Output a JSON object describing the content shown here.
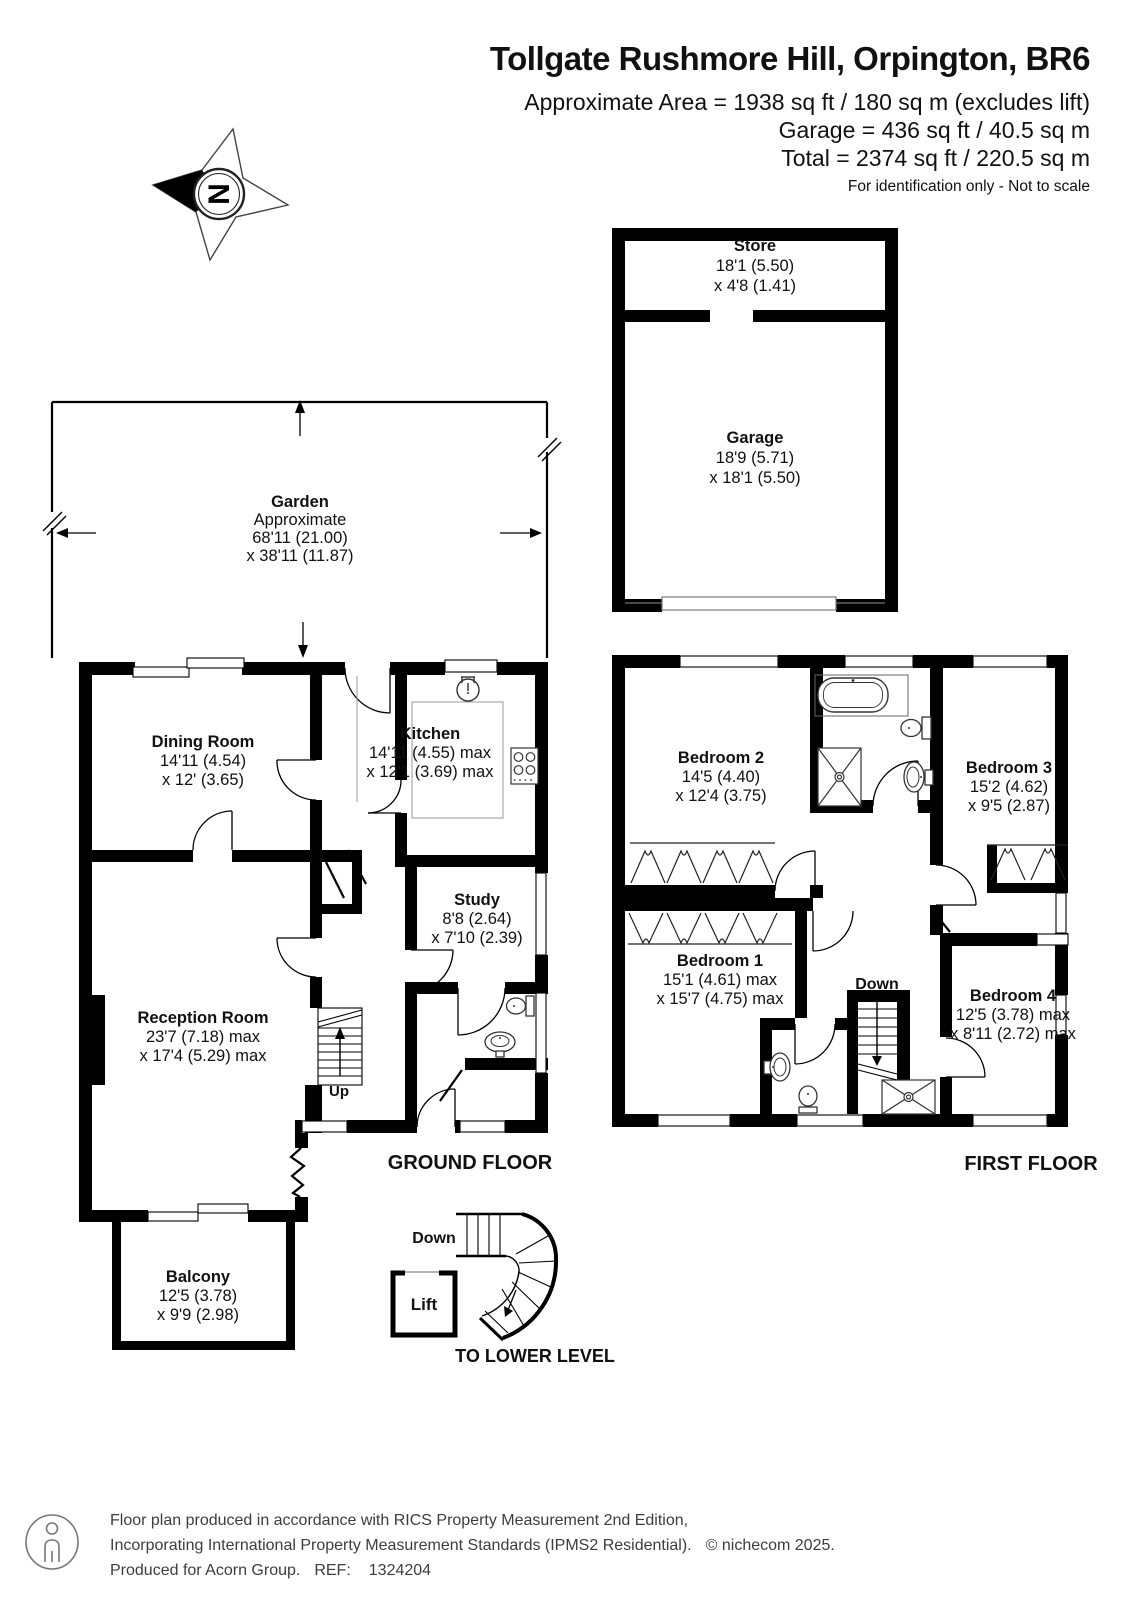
{
  "header": {
    "title": "Tollgate Rushmore Hill, Orpington, BR6",
    "area_line1": "Approximate Area = 1938 sq ft / 180 sq m (excludes lift)",
    "area_line2": "Garage = 436 sq ft / 40.5 sq m",
    "area_line3": "Total = 2374 sq ft / 220.5 sq m",
    "disclaimer": "For identification only - Not to scale"
  },
  "compass": {
    "north_label": "N"
  },
  "rooms": {
    "store": {
      "name": "Store",
      "dim1": "18'1 (5.50)",
      "dim2": "x 4'8 (1.41)"
    },
    "garage": {
      "name": "Garage",
      "dim1": "18'9 (5.71)",
      "dim2": "x 18'1 (5.50)"
    },
    "garden": {
      "name": "Garden",
      "note": "Approximate",
      "dim1": "68'11 (21.00)",
      "dim2": "x 38'11 (11.87)"
    },
    "dining_room": {
      "name": "Dining Room",
      "dim1": "14'11 (4.54)",
      "dim2": "x 12' (3.65)"
    },
    "kitchen": {
      "name": "Kitchen",
      "dim1": "14'11 (4.55) max",
      "dim2": "x 12'1 (3.69) max"
    },
    "study": {
      "name": "Study",
      "dim1": "8'8 (2.64)",
      "dim2": "x 7'10 (2.39)"
    },
    "reception_room": {
      "name": "Reception Room",
      "dim1": "23'7 (7.18) max",
      "dim2": "x 17'4 (5.29) max"
    },
    "balcony": {
      "name": "Balcony",
      "dim1": "12'5 (3.78)",
      "dim2": "x 9'9 (2.98)"
    },
    "bedroom_1": {
      "name": "Bedroom 1",
      "dim1": "15'1 (4.61) max",
      "dim2": "x 15'7 (4.75) max"
    },
    "bedroom_2": {
      "name": "Bedroom 2",
      "dim1": "14'5 (4.40)",
      "dim2": "x 12'4 (3.75)"
    },
    "bedroom_3": {
      "name": "Bedroom 3",
      "dim1": "15'2 (4.62)",
      "dim2": "x 9'5 (2.87)"
    },
    "bedroom_4": {
      "name": "Bedroom 4",
      "dim1": "12'5 (3.78) max",
      "dim2": "x 8'11 (2.72) max"
    },
    "lift": {
      "name": "Lift"
    }
  },
  "labels": {
    "ground_floor": "GROUND FLOOR",
    "first_floor": "FIRST FLOOR",
    "to_lower_level": "TO LOWER LEVEL",
    "up": "Up",
    "down": "Down"
  },
  "footer": {
    "line1": "Floor plan produced in accordance with RICS Property Measurement 2nd Edition,",
    "line2": "Incorporating International Property Measurement Standards (IPMS2 Residential).",
    "copyright": "© nichecom 2025.",
    "produced_for": "Produced for Acorn Group.",
    "ref_label": "REF:",
    "ref_value": "1324204"
  },
  "colors": {
    "wall": "#000000",
    "background": "#ffffff",
    "fixture_line": "#333333",
    "counter_line": "#999999"
  }
}
